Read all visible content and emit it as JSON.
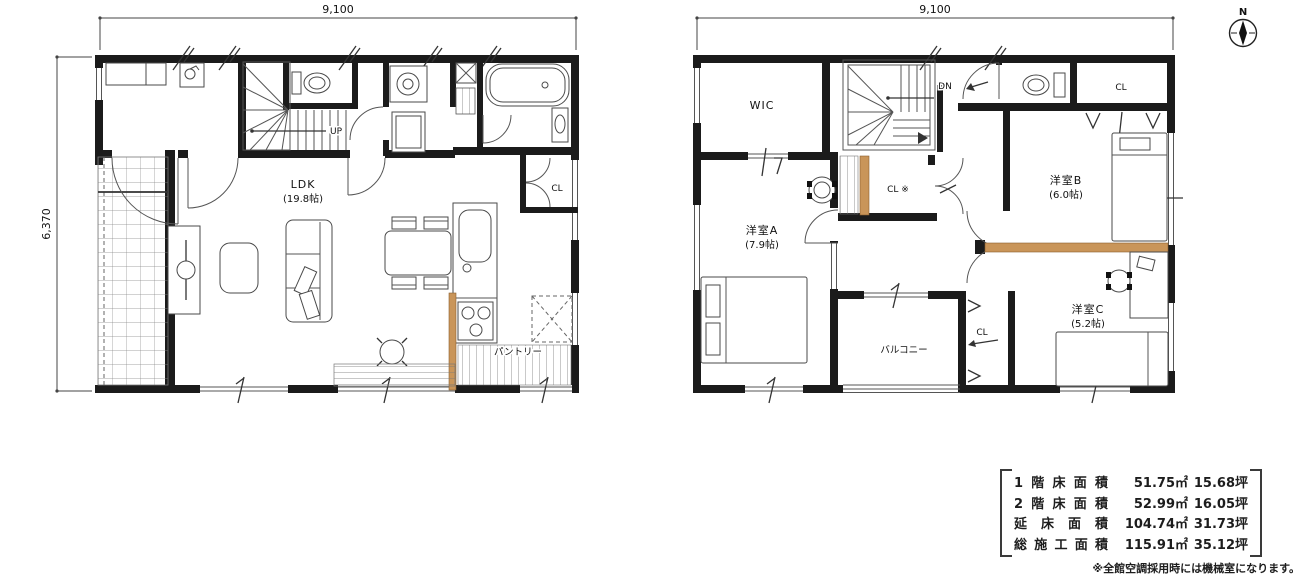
{
  "floor1": {
    "width_dim": "9,100",
    "height_dim": "6,370",
    "ldk_name": "LDK",
    "ldk_size": "(19.8帖)",
    "up_label": "UP",
    "cl_label": "CL",
    "pantry_label": "パントリー"
  },
  "floor2": {
    "width_dim": "9,100",
    "wic_label": "WIC",
    "dn_label": "DN",
    "cl_mid_label": "CL ※",
    "cl_top_label": "CL",
    "cl_bottom_label": "CL",
    "room_a_name": "洋室A",
    "room_a_size": "(7.9帖)",
    "room_b_name": "洋室B",
    "room_b_size": "(6.0帖)",
    "room_c_name": "洋室C",
    "room_c_size": "(5.2帖)",
    "balcony_label": "バルコニー"
  },
  "compass": {
    "north_label": "N"
  },
  "area_table": {
    "rows": [
      {
        "label": "1階床面積",
        "sqm": "51.75㎡",
        "tsubo": "15.68坪"
      },
      {
        "label": "2階床面積",
        "sqm": "52.99㎡",
        "tsubo": "16.05坪"
      },
      {
        "label": "延床面積",
        "sqm": "104.74㎡",
        "tsubo": "31.73坪"
      },
      {
        "label": "総施工面積",
        "sqm": "115.91㎡",
        "tsubo": "35.12坪"
      }
    ],
    "note": "※全館空調採用時には機械室になります。"
  },
  "colors": {
    "wall": "#1b1b1b",
    "wood_accent": "#c99559"
  }
}
